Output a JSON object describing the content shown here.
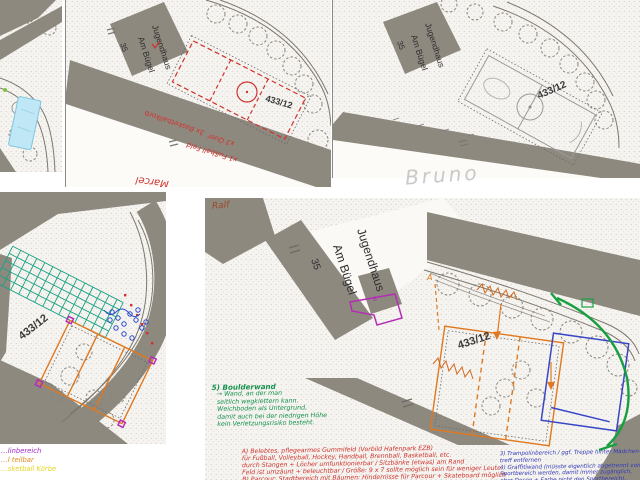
{
  "colors": {
    "red_pen": "#d0322e",
    "green_pen": "#13924d",
    "blue_pen": "#3038b8",
    "orange_pen": "#e07820",
    "purple_pen": "#b52db5",
    "teal_pen": "#1aa385",
    "yellow_pen": "#e3d520",
    "cyan_highlight": "#bfe7f5"
  },
  "panels": {
    "top_middle": {
      "building_label": "Jugendhaus",
      "street_label": "Am Bügel",
      "house_number": "35",
      "parcel_number": "433/12",
      "author_signature": "Marcel",
      "annotation_basketball": "3x Basketballkorb",
      "annotation_quer": "x3 Quer",
      "annotation_field": "x1 Fußball Feld"
    },
    "top_right": {
      "building_label": "Jugendhaus",
      "street_label": "Am Bügel",
      "house_number": "35",
      "parcel_number": "433/12",
      "author_signature": "Bruno"
    },
    "bottom_left": {
      "parcel_number": "433/12",
      "legend": [
        {
          "text": "…linbereich"
        },
        {
          "text": "…l teilbar"
        },
        {
          "text": "…sketball Körbe"
        }
      ]
    },
    "bottom_right": {
      "author_signature": "Ralf",
      "building_label": "Jugendhaus",
      "street_label": "Am Bügel",
      "house_number": "35",
      "parcel_number": "433/12",
      "marker_a": "A",
      "marker_b": "B"
    }
  },
  "notes": {
    "green": {
      "heading": "5) Boulderwand",
      "lines": [
        "→ Wand, an der man",
        "seitlich wegklettern kann.",
        "Weichboden als Untergrund,",
        "damit auch bei der niedrigen Höhe",
        "kein Verletzungsrisiko besteht."
      ]
    },
    "red": {
      "lines": [
        "A) Belebtes, pflegearmes Gummifeld (Vorbild Hafenpark EZB)",
        "für Fußball, Volleyball, Hockey, Handball, Brennball, Basketball, etc.",
        "durch Stangen + Löcher umfunktionierbar / Sitzbänke (etwas) am Rand",
        "Feld ist umzäunt + beleuchtbar / Größe: 9 x 7 sollte möglich sein für weniger Leute",
        "B) Parcour: Stadtbereich mit Bäumen: Hindernisse für Parcour + Skateboard möglich"
      ]
    },
    "blue": {
      "lines": [
        "3) Trampolinbereich / ggf. Treppe hinter Mädchen-",
        "treff entfernen",
        "4) Graffitiwand (müsste eigentlich abgetrennt vom",
        "Sportbereich werden, damit immer zugänglich,",
        "aber Dosen + Farbe nicht den Sportbereich)."
      ]
    }
  }
}
